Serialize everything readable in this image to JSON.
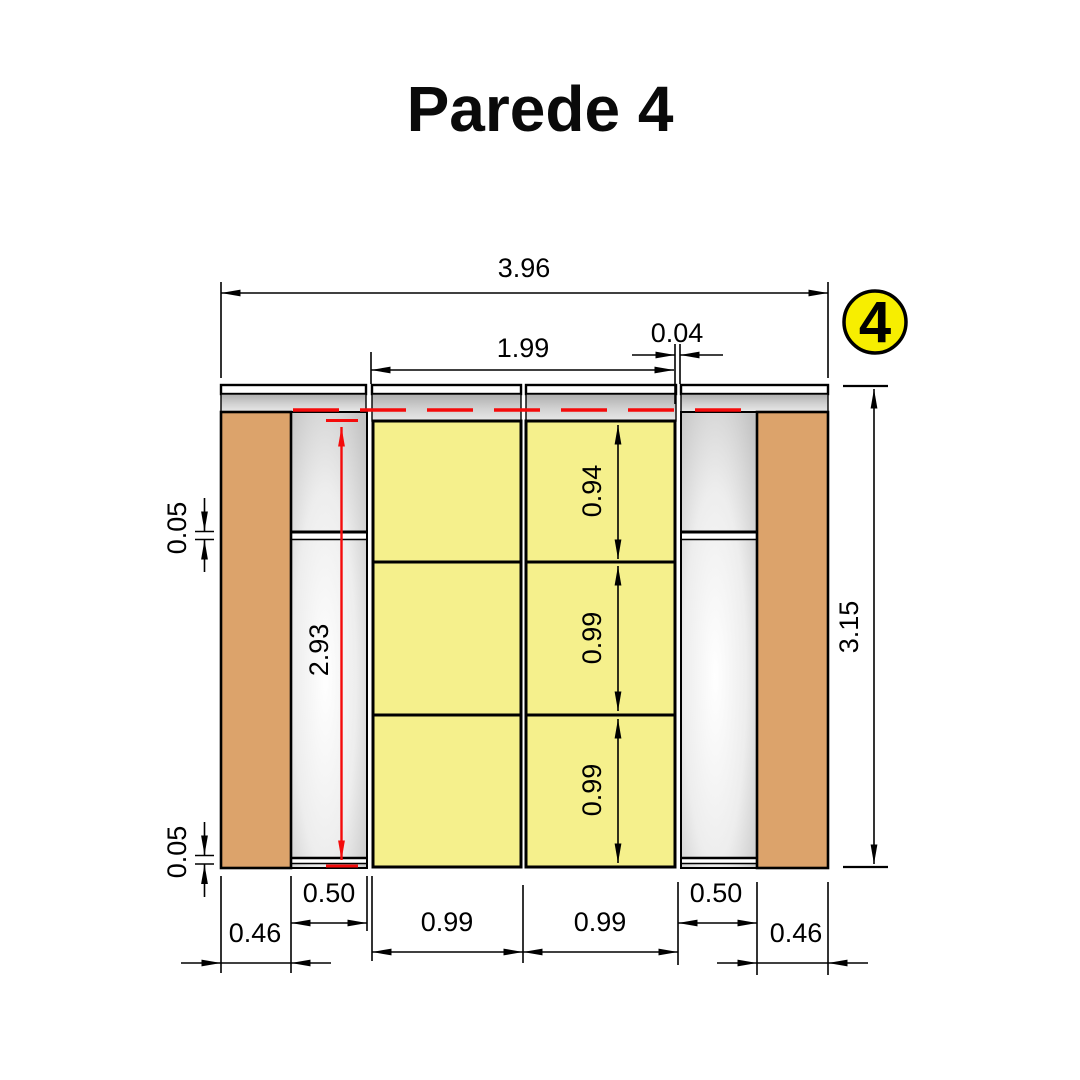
{
  "title": "Parede 4",
  "badge": {
    "label": "4",
    "fill": "#f7ee00"
  },
  "colors": {
    "panel_yellow": "#f5f08c",
    "stud_brown": "#dca36b",
    "dim_red": "#f40b0b",
    "line_black": "#000000"
  },
  "dimensions": {
    "overall_width": "3.96",
    "inner_width": "1.99",
    "gap_width": "0.04",
    "wall_height": "3.15",
    "red_clear_height": "2.93",
    "row_heights": [
      "0.94",
      "0.99",
      "0.99"
    ],
    "joint_top": "0.05",
    "joint_bottom": "0.05",
    "bottom": [
      "0.46",
      "0.50",
      "0.99",
      "0.99",
      "0.50",
      "0.46"
    ]
  }
}
